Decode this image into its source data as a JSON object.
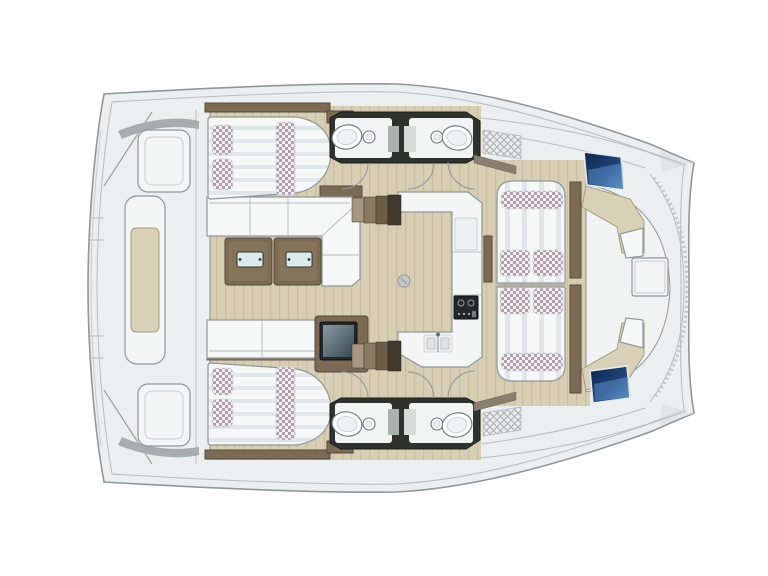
{
  "meta": {
    "subject": "Catamaran yacht floor plan, top view, bow to the right",
    "visible_text": "none"
  },
  "palette": {
    "background": "#ffffff",
    "deck": "#ecefef",
    "deck_bright": "#f4f6f6",
    "outline": "#8f979a",
    "outline_soft": "#b6bcbe",
    "floor_wood": "#d7ceb3",
    "floor_wood_grain": "#c9be9f",
    "furniture_wood": "#7b6b54",
    "furniture_wood_dark": "#54483a",
    "upholstery_white": "#f6f8f8",
    "upholstery_stripe": "#e0e6e9",
    "fabric_check": "#b0a0aa",
    "fabric_check_bg": "#f2eff2",
    "wet_area_dark": "#2e3330",
    "hatch_navy_dark": "#0e2747",
    "hatch_navy_light": "#5d93cc",
    "cushion_beige": "#d9d0b8",
    "cushion_beige_edge": "#a89b81",
    "glass_teal": "#dcebea",
    "tv_dark": "#22272a"
  },
  "components": [
    "hull-outline",
    "stern-platform",
    "stern-bench",
    "aft-cabin-port-bed",
    "aft-cabin-starboard-bed",
    "salon-sofa",
    "coffee-table",
    "tv-cabinet",
    "galley-counter",
    "stove",
    "galley-sink",
    "bathroom-port",
    "bathroom-starboard",
    "sink-basin",
    "toilet",
    "hull-stairs",
    "forward-lounge-pads",
    "lounge-cushions",
    "forward-cockpit-bench",
    "forward-cockpit-table",
    "foredeck-hatch-port",
    "foredeck-hatch-starboard",
    "bow-rub-rail"
  ]
}
